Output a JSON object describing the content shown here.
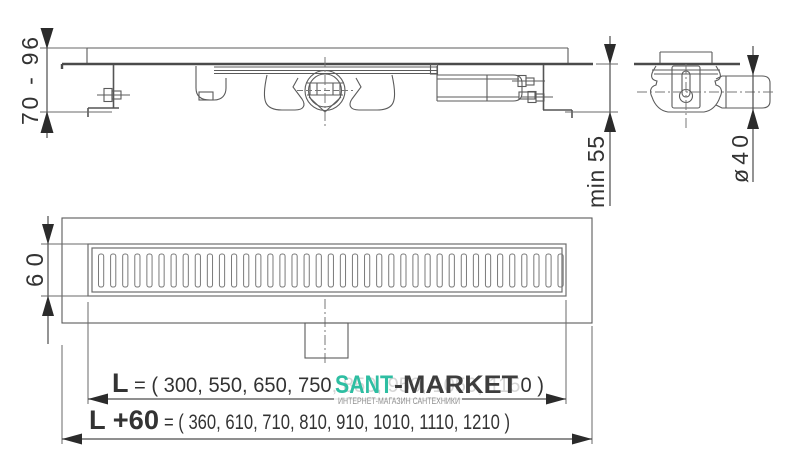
{
  "product_drawing": {
    "type": "linear shower drain installation drawing",
    "views": {
      "side_view": "channel with siphon, adjustable feet and wall brackets",
      "end_view": "siphon body with horizontal outlet pipe",
      "top_view": "drain grate with slots and mounting flange"
    },
    "top_view": {
      "slot_count": 39
    }
  },
  "dimensions": {
    "height_range": "70 - 96",
    "min_depth": "min 55",
    "outlet_diameter": "ø40",
    "grate_width": "60",
    "length_label": "L",
    "length_values": "= ( 300, 550, 650, 750, 850, 950, 1050, 1150 )",
    "length_options": [
      300,
      550,
      650,
      750,
      850,
      950,
      1050,
      1150
    ],
    "length_plus_label": "L +60",
    "length_plus_values": "= ( 360, 610, 710, 810, 910, 1010, 1110, 1210 )",
    "length_plus_options": [
      360,
      610,
      710,
      810,
      910,
      1010,
      1110,
      1210
    ]
  },
  "watermark": {
    "brand_primary": "SANT",
    "brand_secondary": "-MARKET",
    "subtitle": "ИНТЕРНЕТ-МАГАЗИН САНТЕХНИКИ",
    "accent_color": "#2EBEA2",
    "secondary_color": "#3d3d3d"
  }
}
